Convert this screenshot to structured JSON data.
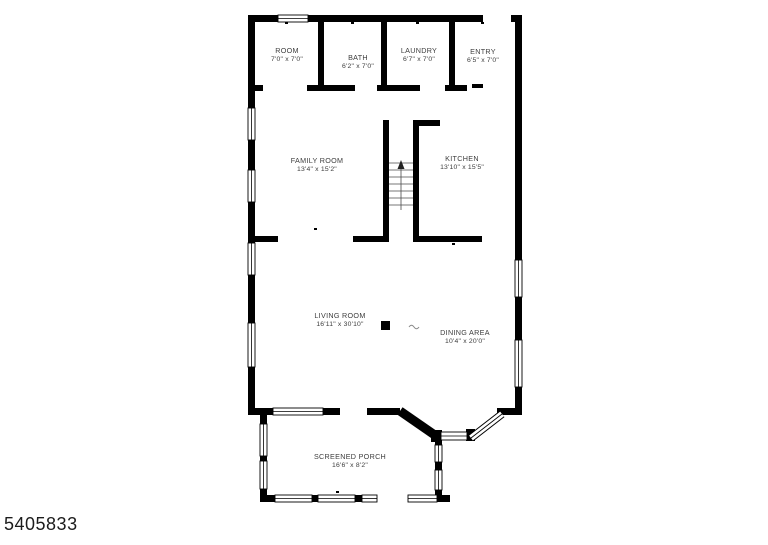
{
  "colors": {
    "background": "#ffffff",
    "walls": "#000000",
    "text": "#3d3d3d",
    "stairs": "#4a4a4a"
  },
  "watermark": {
    "id": "5405833"
  },
  "floorplan": {
    "rooms": [
      {
        "name": "ROOM",
        "dimensions": "7'0\" x 7'0\""
      },
      {
        "name": "BATH",
        "dimensions": "6'2\" x 7'0\""
      },
      {
        "name": "LAUNDRY",
        "dimensions": "6'7\" x 7'0\""
      },
      {
        "name": "ENTRY",
        "dimensions": "6'5\" x 7'0\""
      },
      {
        "name": "FAMILY ROOM",
        "dimensions": "13'4\" x 15'2\""
      },
      {
        "name": "KITCHEN",
        "dimensions": "13'10\" x 15'5\""
      },
      {
        "name": "LIVING ROOM",
        "dimensions": "16'11\" x 30'10\""
      },
      {
        "name": "DINING AREA",
        "dimensions": "10'4\" x 20'0\""
      },
      {
        "name": "SCREENED PORCH",
        "dimensions": "16'6\" x 8'2\""
      }
    ]
  }
}
